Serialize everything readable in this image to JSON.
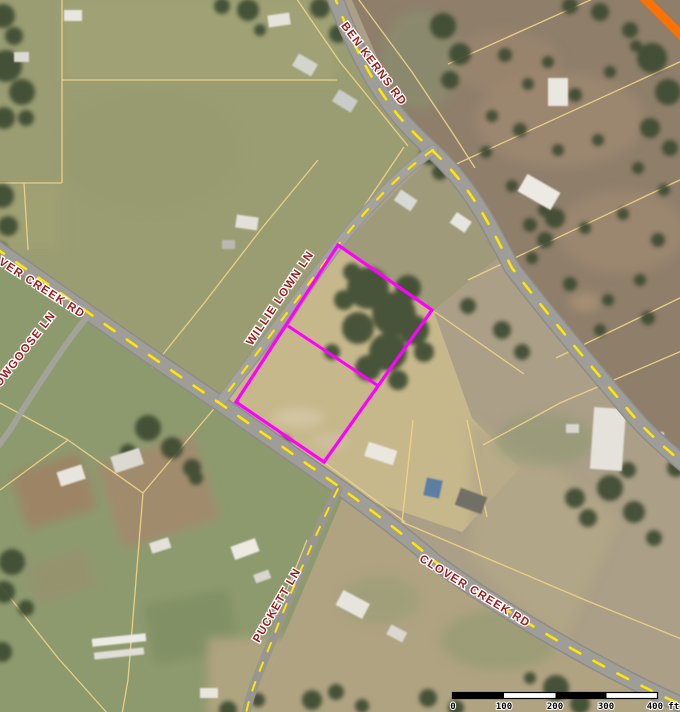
{
  "map": {
    "kind": "aerial-parcel-viewer",
    "road_labels": {
      "ben_kerns": "BEN KERNS RD",
      "clover_creek_west": "VER CREEK RD",
      "nowgoose": "NOWGOOSE LN",
      "willie_lown": "WILLIE LOWN LN",
      "clover_creek": "CLOVER CREEK RD",
      "puckett": "PUCKETT LN"
    },
    "label_style": {
      "color": "#9a1b1b",
      "halo": "#ffffff"
    },
    "line_colors": {
      "parcel_line": "#eed287",
      "road_dash": "#ffe600",
      "road_fill": "#9e9d97",
      "highlight": "#ff00ff",
      "highway_stripe": "#f97306"
    },
    "scale_bar": {
      "ticks": [
        "0",
        "100",
        "200",
        "300",
        "400 ft"
      ],
      "units": "ft"
    }
  }
}
